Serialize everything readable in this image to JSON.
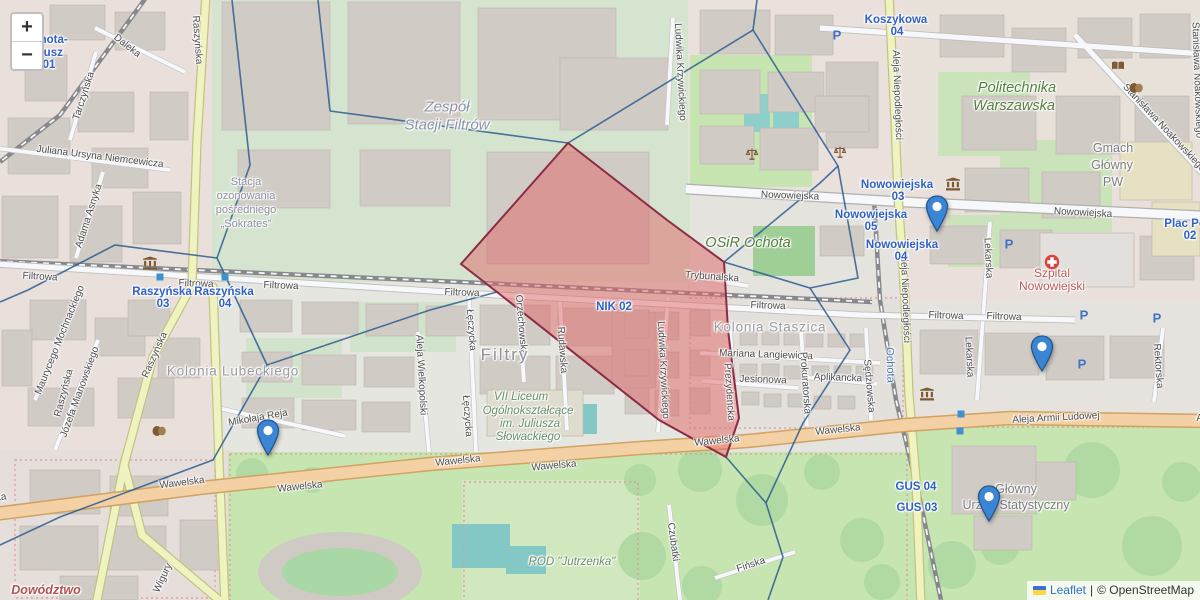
{
  "controls": {
    "zoom_in": "+",
    "zoom_out": "−"
  },
  "attribution": {
    "leaflet": "Leaflet",
    "separator": "|",
    "osm": "© OpenStreetMap",
    "flag_blue": "#3e6ed0",
    "flag_yellow": "#f8d748"
  },
  "overlay": {
    "edge_color": "#2c5d8f",
    "red_zone": {
      "fill": "#e06666",
      "fill_opacity": 0.5,
      "stroke": "#8c2c44",
      "points": [
        [
          568,
          143
        ],
        [
          667,
          220
        ],
        [
          724,
          262
        ],
        [
          728,
          330
        ],
        [
          739,
          418
        ],
        [
          726,
          457
        ],
        [
          659,
          420
        ],
        [
          497,
          292
        ],
        [
          461,
          264
        ]
      ]
    },
    "cell_edges": [
      [
        [
          318,
          0
        ],
        [
          330,
          111
        ]
      ],
      [
        [
          330,
          111
        ],
        [
          568,
          143
        ]
      ],
      [
        [
          232,
          0
        ],
        [
          250,
          165
        ],
        [
          217,
          258
        ]
      ],
      [
        [
          217,
          258
        ],
        [
          115,
          245
        ],
        [
          28,
          290
        ],
        [
          0,
          302
        ]
      ],
      [
        [
          217,
          258
        ],
        [
          267,
          365
        ]
      ],
      [
        [
          267,
          365
        ],
        [
          430,
          310
        ],
        [
          497,
          292
        ]
      ],
      [
        [
          267,
          365
        ],
        [
          213,
          460
        ],
        [
          60,
          517
        ],
        [
          0,
          545
        ]
      ],
      [
        [
          568,
          143
        ],
        [
          753,
          30
        ],
        [
          757,
          0
        ]
      ],
      [
        [
          753,
          30
        ],
        [
          838,
          166
        ]
      ],
      [
        [
          838,
          166
        ],
        [
          820,
          183
        ],
        [
          724,
          262
        ]
      ],
      [
        [
          838,
          166
        ],
        [
          858,
          278
        ],
        [
          810,
          288
        ],
        [
          850,
          350
        ],
        [
          803,
          423
        ],
        [
          766,
          503
        ]
      ],
      [
        [
          724,
          262
        ],
        [
          810,
          288
        ]
      ],
      [
        [
          726,
          457
        ],
        [
          766,
          503
        ]
      ],
      [
        [
          766,
          503
        ],
        [
          783,
          557
        ],
        [
          768,
          600
        ]
      ]
    ]
  },
  "marker_style": {
    "fill": "#3a86d5",
    "stroke": "#24568c"
  },
  "markers": [
    {
      "x": 268,
      "y": 457
    },
    {
      "x": 937,
      "y": 233
    },
    {
      "x": 1042,
      "y": 373
    },
    {
      "x": 989,
      "y": 523
    }
  ],
  "labels": [
    {
      "text": "Daleka",
      "x": 127,
      "y": 46,
      "rot": 38,
      "style": "street"
    },
    {
      "text": "Tarczyńska",
      "x": 84,
      "y": 96,
      "rot": -72,
      "style": "street"
    },
    {
      "text": "Raszyńska",
      "x": 197,
      "y": 40,
      "rot": 86,
      "style": "street"
    },
    {
      "text": "Juliana Ursyna Niemcewicza",
      "x": 100,
      "y": 157,
      "rot": 7,
      "style": "street"
    },
    {
      "text": "Adama Asnyka",
      "x": 89,
      "y": 216,
      "rot": -72,
      "style": "street"
    },
    {
      "text": "Maurycego Mochnackiego",
      "x": 60,
      "y": 340,
      "rot": -68,
      "style": "street"
    },
    {
      "text": "Józefa Mianowskiego",
      "x": 80,
      "y": 392,
      "rot": -70,
      "style": "street"
    },
    {
      "text": "Raszyńska",
      "x": 155,
      "y": 355,
      "rot": -66,
      "style": "street"
    },
    {
      "text": "Raszyńska",
      "x": 64,
      "y": 393,
      "rot": -75,
      "style": "street"
    },
    {
      "text": "Mikołaja Reja",
      "x": 258,
      "y": 418,
      "rot": -10,
      "style": "street"
    },
    {
      "text": "Filtrowa",
      "x": 40,
      "y": 277,
      "rot": 3,
      "style": "street"
    },
    {
      "text": "Filtrowa",
      "x": 196,
      "y": 284,
      "rot": 2,
      "style": "street"
    },
    {
      "text": "Filtrowa",
      "x": 281,
      "y": 286,
      "rot": 2,
      "style": "street"
    },
    {
      "text": "Filtrowa",
      "x": 462,
      "y": 293,
      "rot": 2,
      "style": "street"
    },
    {
      "text": "Filtrowa",
      "x": 768,
      "y": 306,
      "rot": 2,
      "style": "street"
    },
    {
      "text": "Filtrowa",
      "x": 946,
      "y": 316,
      "rot": 2,
      "style": "street"
    },
    {
      "text": "Filtrowa",
      "x": 1004,
      "y": 317,
      "rot": 2,
      "style": "street"
    },
    {
      "text": "Nowowiejska",
      "x": 790,
      "y": 196,
      "rot": 2,
      "style": "street"
    },
    {
      "text": "Nowowiejska",
      "x": 1083,
      "y": 213,
      "rot": 3,
      "style": "street"
    },
    {
      "text": "Trybunalska",
      "x": 712,
      "y": 277,
      "rot": 4,
      "style": "street"
    },
    {
      "text": "Orzechowska",
      "x": 521,
      "y": 325,
      "rot": 85,
      "style": "street"
    },
    {
      "text": "Rudawska",
      "x": 562,
      "y": 350,
      "rot": 86,
      "style": "street"
    },
    {
      "text": "Łęczycka",
      "x": 471,
      "y": 330,
      "rot": 86,
      "style": "street"
    },
    {
      "text": "Łęczycka",
      "x": 467,
      "y": 416,
      "rot": 86,
      "style": "street"
    },
    {
      "text": "Aleja Wielkopolski",
      "x": 421,
      "y": 375,
      "rot": 87,
      "style": "street"
    },
    {
      "text": "Ludwika Krzywickiego",
      "x": 680,
      "y": 72,
      "rot": 87,
      "style": "street"
    },
    {
      "text": "Ludwika Krzywickiego",
      "x": 663,
      "y": 370,
      "rot": 87,
      "style": "street"
    },
    {
      "text": "Mariana Langiewicza",
      "x": 766,
      "y": 355,
      "rot": 2,
      "style": "street"
    },
    {
      "text": "Jesionowa",
      "x": 763,
      "y": 380,
      "rot": 2,
      "style": "street"
    },
    {
      "text": "Aplikancka",
      "x": 838,
      "y": 378,
      "rot": 2,
      "style": "street"
    },
    {
      "text": "Prokuratorska",
      "x": 805,
      "y": 383,
      "rot": 86,
      "style": "street"
    },
    {
      "text": "Prezydencka",
      "x": 729,
      "y": 392,
      "rot": 86,
      "style": "street"
    },
    {
      "text": "Sędziowska",
      "x": 869,
      "y": 386,
      "rot": 85,
      "style": "street"
    },
    {
      "text": "Lekarska",
      "x": 988,
      "y": 258,
      "rot": 87,
      "style": "street"
    },
    {
      "text": "Lekarska",
      "x": 969,
      "y": 357,
      "rot": 87,
      "style": "street"
    },
    {
      "text": "Rektorska",
      "x": 1158,
      "y": 366,
      "rot": 86,
      "style": "street"
    },
    {
      "text": "Aleja Niepodległości",
      "x": 897,
      "y": 95,
      "rot": 88,
      "style": "street"
    },
    {
      "text": "Aleja Niepodległości",
      "x": 905,
      "y": 298,
      "rot": 88,
      "style": "street"
    },
    {
      "text": "Stanisława Noakowskiego",
      "x": 1164,
      "y": 128,
      "rot": 47,
      "style": "street"
    },
    {
      "text": "Stanisława Noakowskiego",
      "x": 1197,
      "y": 80,
      "rot": 88,
      "style": "street"
    },
    {
      "text": "Wawelska",
      "x": 182,
      "y": 483,
      "rot": -7,
      "style": "street"
    },
    {
      "text": "Wawelska",
      "x": 300,
      "y": 487,
      "rot": -6,
      "style": "street"
    },
    {
      "text": "Wawelska",
      "x": 458,
      "y": 461,
      "rot": -6,
      "style": "street"
    },
    {
      "text": "Wawelska",
      "x": 554,
      "y": 466,
      "rot": -5,
      "style": "street"
    },
    {
      "text": "Wawelska",
      "x": 717,
      "y": 441,
      "rot": -6,
      "style": "street"
    },
    {
      "text": "Wawelska",
      "x": 838,
      "y": 430,
      "rot": -6,
      "style": "street"
    },
    {
      "text": "Wawelska",
      "x": -16,
      "y": 500,
      "rot": -8,
      "style": "street"
    },
    {
      "text": "Aleja Armii Ludowej",
      "x": 1056,
      "y": 418,
      "rot": -3,
      "style": "street"
    },
    {
      "text": "Aleja Armii Ludowej",
      "x": 1240,
      "y": 417,
      "rot": -2,
      "style": "street"
    },
    {
      "text": "Wigury",
      "x": 163,
      "y": 578,
      "rot": -65,
      "style": "street"
    },
    {
      "text": "Czubatki",
      "x": 673,
      "y": 542,
      "rot": 82,
      "style": "street"
    },
    {
      "text": "Fińska",
      "x": 751,
      "y": 565,
      "rot": -18,
      "style": "street"
    },
    {
      "text": "Ochota-",
      "x": 46,
      "y": 40,
      "rot": 0,
      "style": "blue"
    },
    {
      "text": "Ratusz",
      "x": 44,
      "y": 53,
      "rot": 0,
      "style": "blue"
    },
    {
      "text": "01",
      "x": 49,
      "y": 65,
      "rot": 0,
      "style": "blue"
    },
    {
      "text": "Nowowiejska",
      "x": 897,
      "y": 185,
      "rot": 0,
      "style": "blue"
    },
    {
      "text": "03",
      "x": 898,
      "y": 197,
      "rot": 0,
      "style": "blue"
    },
    {
      "text": "Nowowiejska",
      "x": 871,
      "y": 215,
      "rot": 0,
      "style": "blue"
    },
    {
      "text": "05",
      "x": 871,
      "y": 227,
      "rot": 0,
      "style": "blue"
    },
    {
      "text": "Nowowiejska",
      "x": 902,
      "y": 245,
      "rot": 0,
      "style": "blue"
    },
    {
      "text": "04",
      "x": 901,
      "y": 257,
      "rot": 0,
      "style": "blue"
    },
    {
      "text": "Koszykowa",
      "x": 896,
      "y": 20,
      "rot": 0,
      "style": "blue"
    },
    {
      "text": "04",
      "x": 897,
      "y": 32,
      "rot": 0,
      "style": "blue"
    },
    {
      "text": "Plac Politechniki",
      "x": 1210,
      "y": 224,
      "rot": 0,
      "style": "blue"
    },
    {
      "text": "02",
      "x": 1190,
      "y": 236,
      "rot": 0,
      "style": "blue"
    },
    {
      "text": "Raszyńska",
      "x": 162,
      "y": 292,
      "rot": 0,
      "style": "blue"
    },
    {
      "text": "03",
      "x": 163,
      "y": 304,
      "rot": 0,
      "style": "blue"
    },
    {
      "text": "Raszyńska",
      "x": 224,
      "y": 292,
      "rot": 0,
      "style": "blue"
    },
    {
      "text": "04",
      "x": 225,
      "y": 304,
      "rot": 0,
      "style": "blue"
    },
    {
      "text": "NIK 02",
      "x": 614,
      "y": 307,
      "rot": 0,
      "style": "blue"
    },
    {
      "text": "GUS 04",
      "x": 916,
      "y": 487,
      "rot": 0,
      "style": "blue"
    },
    {
      "text": "GUS 03",
      "x": 917,
      "y": 508,
      "rot": 0,
      "style": "blue"
    },
    {
      "text": "Ochota",
      "x": 890,
      "y": 365,
      "rot": 88,
      "style": "station"
    },
    {
      "text": "Zespół",
      "x": 447,
      "y": 107,
      "rot": 0,
      "style": "indus"
    },
    {
      "text": "Stacji Filtrów",
      "x": 447,
      "y": 125,
      "rot": 0,
      "style": "indus"
    },
    {
      "text": "Stacja",
      "x": 246,
      "y": 182,
      "rot": 0,
      "style": "areasm"
    },
    {
      "text": "ozonowania",
      "x": 246,
      "y": 196,
      "rot": 0,
      "style": "areasm"
    },
    {
      "text": "pośredniego",
      "x": 246,
      "y": 210,
      "rot": 0,
      "style": "areasm"
    },
    {
      "text": "„Sokrates”",
      "x": 246,
      "y": 224,
      "rot": 0,
      "style": "areasm"
    },
    {
      "text": "Politechnika",
      "x": 1017,
      "y": 88,
      "rot": 0,
      "style": "green"
    },
    {
      "text": "Warszawska",
      "x": 1014,
      "y": 106,
      "rot": 0,
      "style": "green"
    },
    {
      "text": "OSiR Ochota",
      "x": 748,
      "y": 243,
      "rot": 0,
      "style": "green"
    },
    {
      "text": "Gmach",
      "x": 1113,
      "y": 148,
      "rot": 0,
      "style": "gray"
    },
    {
      "text": "Główny",
      "x": 1112,
      "y": 165,
      "rot": 0,
      "style": "gray"
    },
    {
      "text": "PW",
      "x": 1113,
      "y": 182,
      "rot": 0,
      "style": "gray"
    },
    {
      "text": "Szpital",
      "x": 1052,
      "y": 273,
      "rot": 0,
      "style": "hosp"
    },
    {
      "text": "Nowowiejski",
      "x": 1052,
      "y": 286,
      "rot": 0,
      "style": "hosp"
    },
    {
      "text": "Kolonia Staszica",
      "x": 770,
      "y": 327,
      "rot": 0,
      "style": "area"
    },
    {
      "text": "Kolonia Lubeckiego",
      "x": 233,
      "y": 371,
      "rot": 0,
      "style": "area"
    },
    {
      "text": "Filtry",
      "x": 505,
      "y": 355,
      "rot": 0,
      "style": "arealg"
    },
    {
      "text": "VII Liceum",
      "x": 521,
      "y": 397,
      "rot": 0,
      "style": "greensm"
    },
    {
      "text": "Ogólnokształcące",
      "x": 528,
      "y": 411,
      "rot": 0,
      "style": "greensm"
    },
    {
      "text": "im. Juliusza",
      "x": 530,
      "y": 424,
      "rot": 0,
      "style": "greensm"
    },
    {
      "text": "Słowackiego",
      "x": 528,
      "y": 437,
      "rot": 0,
      "style": "greensm"
    },
    {
      "text": "ROD \"Jutrzenka\"",
      "x": 572,
      "y": 562,
      "rot": 0,
      "style": "greensm"
    },
    {
      "text": "Główny",
      "x": 1016,
      "y": 489,
      "rot": 0,
      "style": "gray"
    },
    {
      "text": "Urząd Statystyczny",
      "x": 1016,
      "y": 505,
      "rot": 0,
      "style": "gray"
    },
    {
      "text": "Dowództwo",
      "x": 46,
      "y": 590,
      "rot": 0,
      "style": "mil"
    }
  ],
  "icons": [
    {
      "type": "museum",
      "x": 150,
      "y": 263
    },
    {
      "type": "museum",
      "x": 953,
      "y": 184
    },
    {
      "type": "museum",
      "x": 927,
      "y": 394
    },
    {
      "type": "masks",
      "x": 159,
      "y": 431
    },
    {
      "type": "masks",
      "x": 1136,
      "y": 88
    },
    {
      "type": "book",
      "x": 1118,
      "y": 66
    },
    {
      "type": "scales",
      "x": 752,
      "y": 154
    },
    {
      "type": "scales",
      "x": 840,
      "y": 152
    },
    {
      "type": "cross",
      "x": 1052,
      "y": 262
    },
    {
      "type": "parking",
      "x": 837,
      "y": 35
    },
    {
      "type": "parking",
      "x": 1009,
      "y": 244
    },
    {
      "type": "parking",
      "x": 1084,
      "y": 315
    },
    {
      "type": "parking",
      "x": 1082,
      "y": 364
    },
    {
      "type": "parking",
      "x": 1157,
      "y": 318
    },
    {
      "type": "stop",
      "x": 961,
      "y": 414
    },
    {
      "type": "stop",
      "x": 960,
      "y": 431
    },
    {
      "type": "stop",
      "x": 160,
      "y": 277
    },
    {
      "type": "stop",
      "x": 225,
      "y": 277
    }
  ]
}
